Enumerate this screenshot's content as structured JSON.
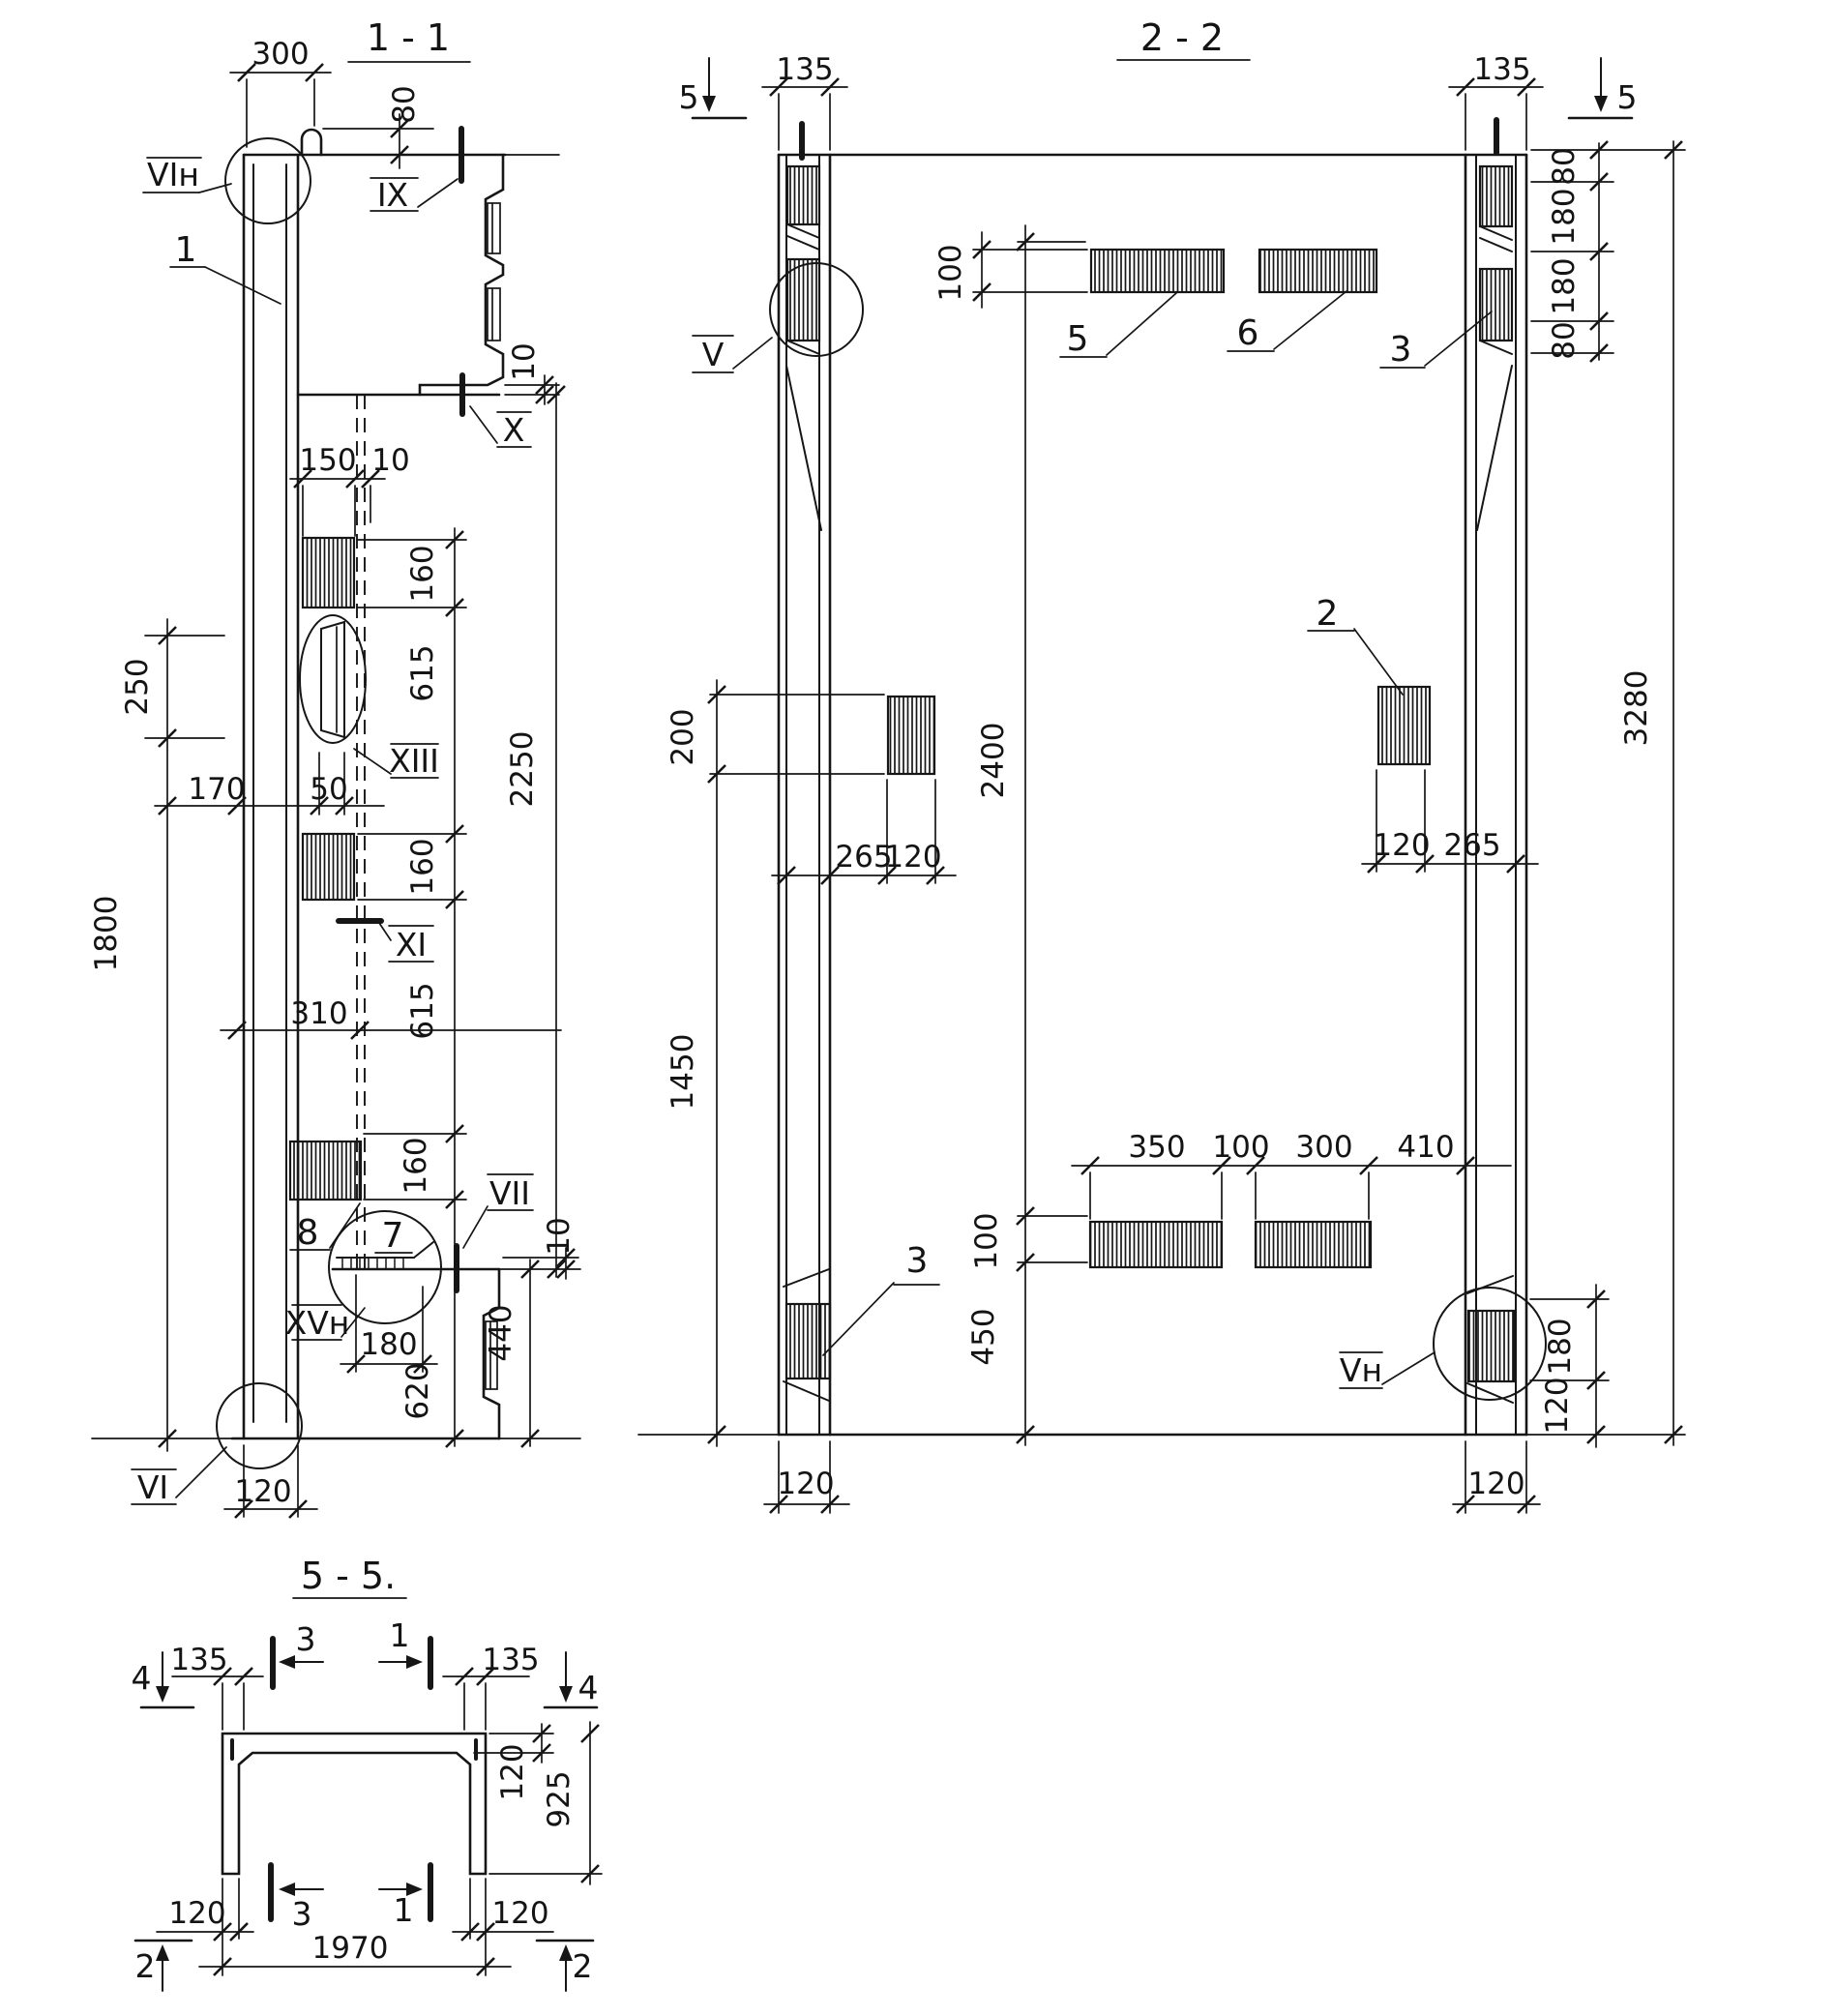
{
  "v11": {
    "title": "1 - 1",
    "dims": {
      "d300": "300",
      "d80": "80",
      "d10a": "10",
      "d150": "150",
      "d10b": "10",
      "d160a": "160",
      "d615a": "615",
      "d160b": "160",
      "d615b": "615",
      "d160c": "160",
      "d2250": "2250",
      "d250": "250",
      "d170": "170",
      "d50": "50",
      "d310": "310",
      "d1800": "1800",
      "d180": "180",
      "d620": "620",
      "d440": "440",
      "d10c": "10",
      "d120": "120"
    },
    "sections": {
      "vin": "VIн",
      "ix": "IX",
      "x": "X",
      "xiii": "XIII",
      "xi": "XI",
      "vii": "VII",
      "xvn": "XVн",
      "vi": "VI"
    },
    "parts": {
      "p1": "1",
      "p7": "7",
      "p8": "8"
    }
  },
  "v22": {
    "title": "2 - 2",
    "dims": {
      "d135l": "135",
      "d135r": "135",
      "d80a": "80",
      "d180a": "180",
      "d180b": "180",
      "d80b": "80",
      "d3280": "3280",
      "d100a": "100",
      "d200": "200",
      "d265l": "265",
      "d120a": "120",
      "d2400": "2400",
      "d120b": "120",
      "d265r": "265",
      "d1450": "1450",
      "d350": "350",
      "d100b": "100",
      "d300": "300",
      "d410": "410",
      "d100c": "100",
      "d450": "450",
      "d180c": "180",
      "d120c": "120",
      "d120bl": "120",
      "d120br": "120"
    },
    "sections": {
      "s5l": "5",
      "s5r": "5",
      "v": "V",
      "vn": "Vн"
    },
    "parts": {
      "p5": "5",
      "p6": "6",
      "p3a": "3",
      "p2": "2",
      "p3b": "3"
    }
  },
  "v55": {
    "title": "5 - 5.",
    "dims": {
      "d135l": "135",
      "d135r": "135",
      "d120t": "120",
      "d925": "925",
      "d120bl": "120",
      "d120br": "120",
      "d1970": "1970"
    },
    "sections": {
      "s4l": "4",
      "s4r": "4",
      "s3t": "3",
      "s1t": "1",
      "s3b": "3",
      "s1b": "1",
      "s2l": "2",
      "s2r": "2"
    }
  }
}
